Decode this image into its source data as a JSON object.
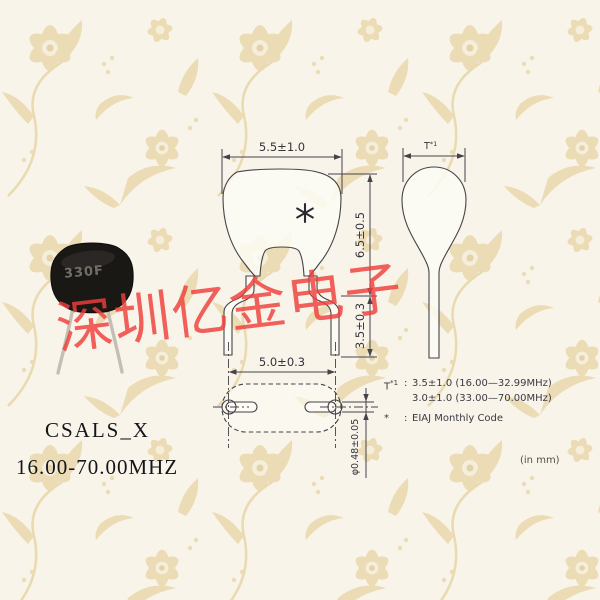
{
  "product": {
    "model": "CSALS_X",
    "frequency_range": "16.00-70.00MHZ"
  },
  "watermark": {
    "text": "深圳亿金电子",
    "color": "#ee3e3a"
  },
  "photo": {
    "marking": "330F",
    "body_color": "#1a1815",
    "lead_color": "#c3bfb6"
  },
  "drawing": {
    "line_color": "#45424a",
    "front": {
      "width_dim": "5.5±1.0",
      "height_dim": "6.5±0.5",
      "lead_length_dim": "3.5±0.3",
      "lead_pitch_dim": "5.0±0.3",
      "lead_diameter_dim": "φ0.48±0.05",
      "mark_icon": "asterisk"
    },
    "side": {
      "thickness_label": "T",
      "thickness_label_sup": "*1"
    },
    "notes": {
      "thickness_label": "T",
      "thickness_label_sup": "*1",
      "colon": ":",
      "thickness_value_line1": "3.5±1.0 (16.00—32.99MHz)",
      "thickness_value_line2": "3.0±1.0 (33.00—70.00MHz)",
      "mark_symbol": "*",
      "mark_value": "EIAJ Monthly Code",
      "unit_note": "(in mm)"
    }
  }
}
